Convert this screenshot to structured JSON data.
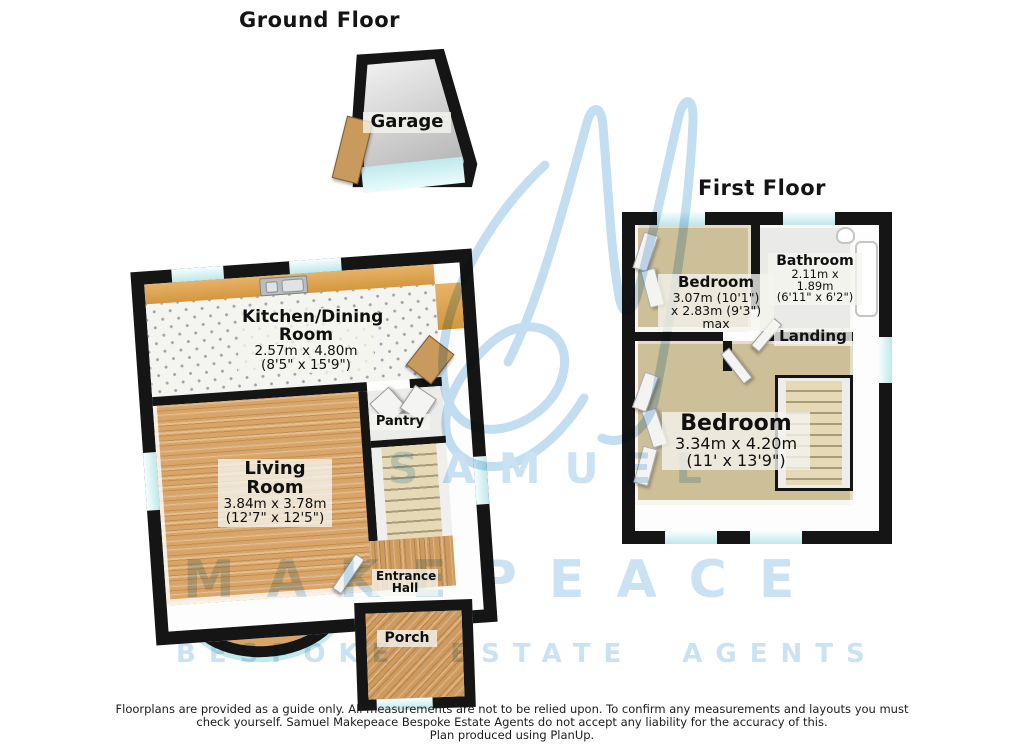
{
  "titles": {
    "ground_floor": "Ground Floor",
    "first_floor": "First Floor"
  },
  "ground_floor": {
    "garage": {
      "name": "Garage"
    },
    "kitchen": {
      "name_line1": "Kitchen/Dining",
      "name_line2": "Room",
      "metric": "2.57m x 4.80m",
      "imperial": "(8'5\" x 15'9\")"
    },
    "living": {
      "name_line1": "Living",
      "name_line2": "Room",
      "metric": "3.84m x 3.78m",
      "imperial": "(12'7\" x 12'5\")"
    },
    "pantry": {
      "name": "Pantry"
    },
    "entrance_hall": {
      "name_line1": "Entrance",
      "name_line2": "Hall"
    },
    "porch": {
      "name": "Porch"
    }
  },
  "first_floor": {
    "bedroom_small": {
      "name": "Bedroom",
      "metric": "3.07m (10'1\")",
      "metric2": "x 2.83m (9'3\") max"
    },
    "bathroom": {
      "name": "Bathroom",
      "metric": "2.11m x 1.89m",
      "imperial": "(6'11\" x 6'2\")"
    },
    "landing": {
      "name": "Landing"
    },
    "bedroom_large": {
      "name": "Bedroom",
      "metric": "3.34m x 4.20m",
      "imperial": "(11' x 13'9\")"
    }
  },
  "watermark": {
    "monogram": "SM",
    "word1": "SAMUEL",
    "word2": "MAKEPEACE",
    "word3": "BESPOKE ESTATE AGENTS",
    "color": "#cbe2f3"
  },
  "disclaimer": {
    "line1": "Floorplans are provided as a guide only.  All measurements are not to be relied upon. To confirm any measurements and layouts you must",
    "line2": "check yourself.  Samuel Makepeace Bespoke Estate Agents do not accept any liability for the accuracy of this.",
    "line3": "Plan produced using PlanUp."
  },
  "colors": {
    "wall": "#151515",
    "wood_floor": "#d9a467",
    "carpet": "#cdbf98",
    "kitchen_tile": "#f4f4f1",
    "counter": "#d3973f",
    "window_glass": "#bfe7ea",
    "watermark_blue": "#cbe2f3"
  }
}
